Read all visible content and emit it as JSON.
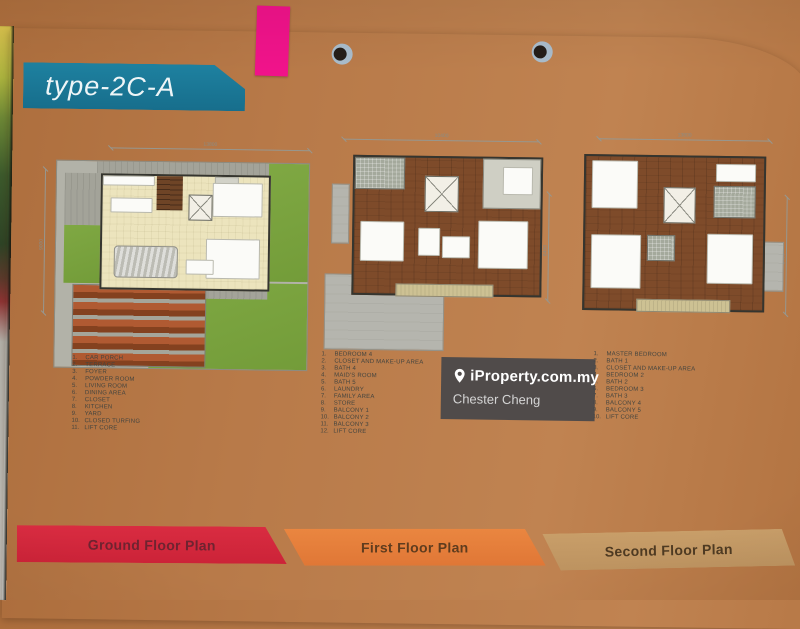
{
  "banner": {
    "title": "type-2C-A"
  },
  "plans": [
    {
      "name": "Ground Floor Plan",
      "dim_width": "13800",
      "dim_height": "9000",
      "legend": [
        "CAR PORCH",
        "TERRACE",
        "FOYER",
        "POWDER ROOM",
        "LIVING ROOM",
        "DINING AREA",
        "CLOSET",
        "KITCHEN",
        "YARD",
        "CLOSED TURFING",
        "LIFT CORE"
      ]
    },
    {
      "name": "First Floor Plan",
      "dim_width": "10400",
      "dim_height": "8400",
      "legend": [
        "BEDROOM 4",
        "CLOSET AND MAKE-UP AREA",
        "BATH 4",
        "MAID'S ROOM",
        "BATH 5",
        "LAUNDRY",
        "FAMILY AREA",
        "STORE",
        "BALCONY 1",
        "BALCONY 2",
        "BALCONY 3",
        "LIFT CORE"
      ]
    },
    {
      "name": "Second Floor Plan",
      "dim_width": "13800",
      "dim_height": "8400",
      "legend": [
        "MASTER BEDROOM",
        "BATH 1",
        "CLOSET AND MAKE-UP AREA",
        "BEDROOM 2",
        "BATH 2",
        "BEDROOM 3",
        "BATH 3",
        "BALCONY 4",
        "BALCONY 5",
        "LIFT CORE"
      ]
    }
  ],
  "watermark": {
    "brand": "iProperty.com.my",
    "agent": "Chester Cheng"
  },
  "colors": {
    "banner_teal": "#1a7895",
    "tab_pink": "#f0138a",
    "ribbon_red": "#d5293d",
    "ribbon_orange": "#e8823d",
    "ribbon_tan": "#c69c66",
    "lawn_green": "#7aa33e",
    "table_wood": "#b5784a"
  }
}
